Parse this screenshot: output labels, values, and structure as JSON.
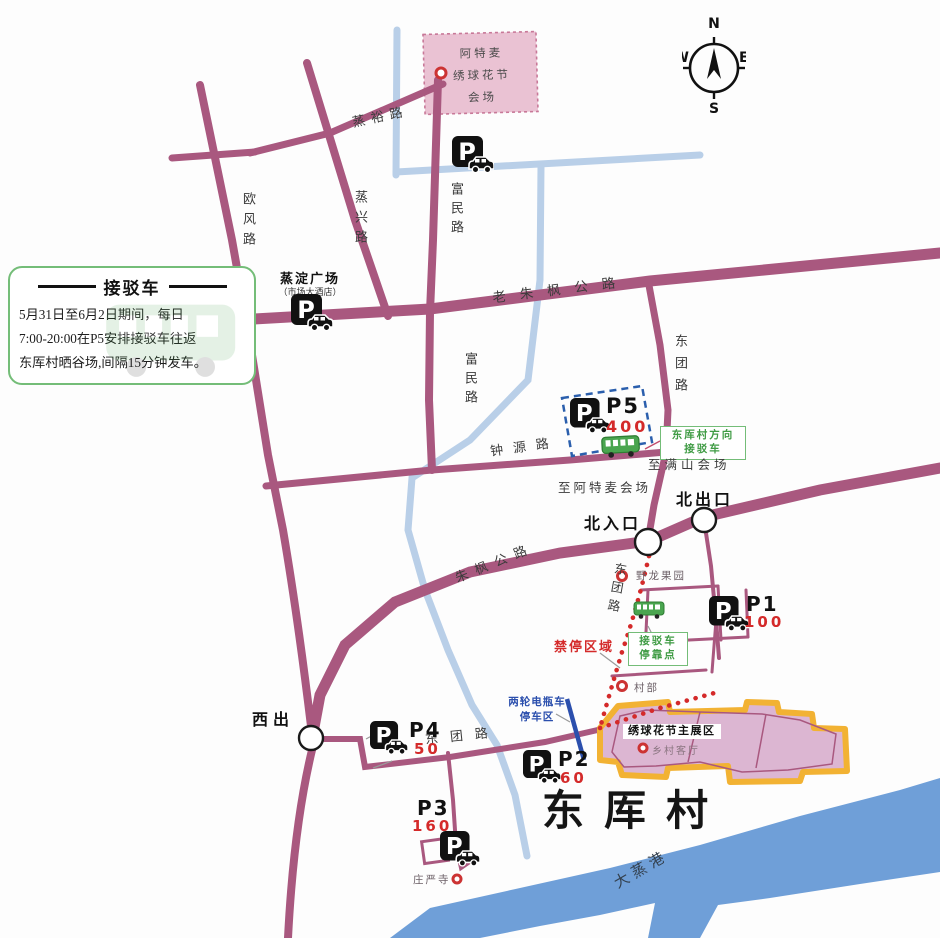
{
  "legend": {
    "title": "接驳车",
    "line1": "5月31日至6月2日期间，每日",
    "line2": "7:00-20:00在P5安排接驳车往返",
    "line3": "东厍村晒谷场,间隔15分钟发车。"
  },
  "compass": {
    "n": "N",
    "e": "E",
    "s": "S",
    "w": "W"
  },
  "venue": {
    "line1": "阿特麦",
    "line2": "绣球花节",
    "line3": "会场"
  },
  "roads": {
    "zhengyu": "蒸裕路",
    "oufeng": "欧风路",
    "zhengxing": "蒸兴路",
    "fumin1": "富民路",
    "fumin2": "富民路",
    "laozhufeng": "老朱枫公路",
    "zhongyuan": "钟源路",
    "zhufeng": "朱枫公路",
    "dongtuan1": "东团路",
    "dongtuan2": "东团路",
    "dongtuan3": "东团路"
  },
  "places": {
    "plaza": "蒸淀广场",
    "plaza_sub": "（市场大酒店）",
    "to_atmai": "至阿特麦会场",
    "to_manshan": "至满山会场",
    "north_entrance": "北入口",
    "north_exit": "北出口",
    "west_exit": "西出",
    "orchard": "野龙果园",
    "village_office": "村部",
    "no_stop_zone": "禁停区域",
    "ebike1": "两轮电瓶车",
    "ebike2": "停车区",
    "main_zone": "绣球花节主展区",
    "village_hall": "乡村客厅",
    "temple": "庄严寺",
    "village": "东厍村",
    "river": "大蒸港"
  },
  "shuttle": {
    "dir1": "东厍村方向",
    "dir2": "接驳车",
    "stop1": "接驳车",
    "stop2": "停靠点"
  },
  "parkings": {
    "p5": {
      "id": "P5",
      "capacity": "400"
    },
    "p1": {
      "id": "P1",
      "capacity": "100"
    },
    "p2": {
      "id": "P2",
      "capacity": "60"
    },
    "p3": {
      "id": "P3",
      "capacity": "160"
    },
    "p4": {
      "id": "P4",
      "capacity": "50"
    }
  },
  "icons": {
    "parking_letter": "P"
  },
  "colors": {
    "road": "#a9587f",
    "canal": "#b9cfe8",
    "river": "#6f9fd8",
    "venue_pink": "#eac2d3",
    "zone_fill": "#dcb6d2",
    "zone_border": "#f2b233",
    "green": "#5fae63",
    "red": "#d42a2a",
    "blue": "#2b4fad"
  }
}
